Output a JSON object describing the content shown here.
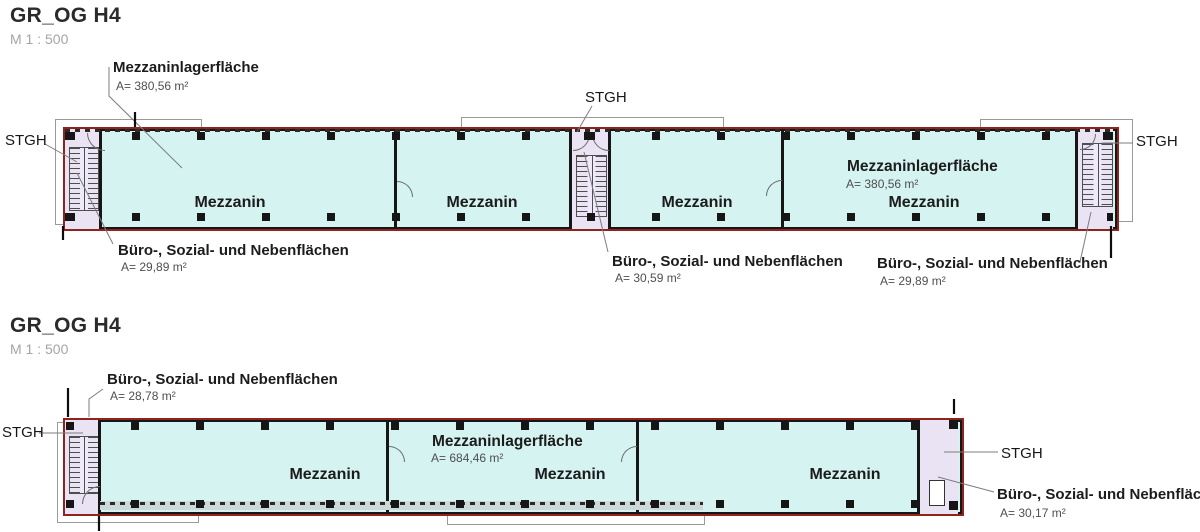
{
  "colors": {
    "room_fill": "#d5f3f1",
    "stair_fill": "#e9e3f4",
    "outline": "#8f231d",
    "wall": "#161616",
    "canopy_outline": "#9a9a9a",
    "leader": "#7d7d7d"
  },
  "plans": {
    "top": {
      "title": "GR_OG H4",
      "scale": "M 1 : 500",
      "stgh": "STGH",
      "rooms": [
        "Mezzanin",
        "Mezzanin",
        "Mezzanin",
        "Mezzanin"
      ],
      "callout_mezz_top": {
        "label": "Mezzaninlagerfläche",
        "area": "A= 380,56 m²"
      },
      "callout_mezz_right": {
        "label": "Mezzaninlagerfläche",
        "area": "A= 380,56 m²"
      },
      "callout_buero_left": {
        "label": "Büro-, Sozial- und Nebenflächen",
        "area": "A= 29,89 m²"
      },
      "callout_buero_mid": {
        "label": "Büro-, Sozial- und Nebenflächen",
        "area": "A= 30,59 m²"
      },
      "callout_buero_right": {
        "label": "Büro-, Sozial- und Nebenflächen",
        "area": "A= 29,89 m²"
      }
    },
    "bottom": {
      "title": "GR_OG H4",
      "scale": "M 1 : 500",
      "stgh": "STGH",
      "rooms": [
        "Mezzanin",
        "Mezzanin",
        "Mezzanin"
      ],
      "callout_mezz": {
        "label": "Mezzaninlagerfläche",
        "area": "A= 684,46 m²"
      },
      "callout_buero_top": {
        "label": "Büro-, Sozial- und Nebenflächen",
        "area": "A= 28,78 m²"
      },
      "callout_buero_right": {
        "label": "Büro-, Sozial- und Nebenflächen",
        "area": "A= 30,17 m²"
      }
    }
  }
}
